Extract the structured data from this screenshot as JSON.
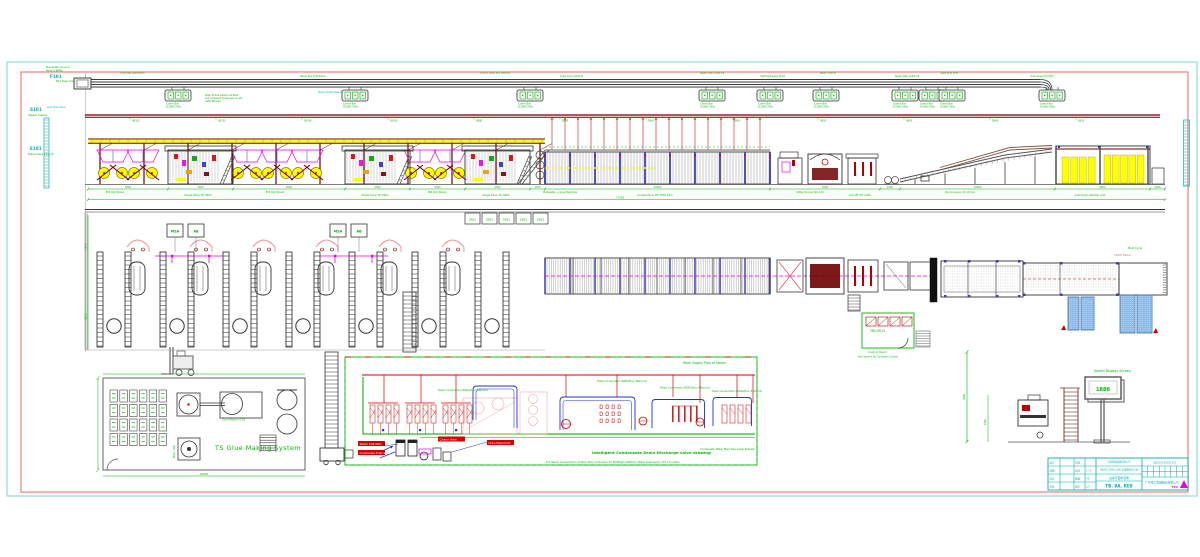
{
  "colors": {
    "green": "#00B400",
    "cyan": "#00AEAE",
    "magenta": "#E800E8",
    "dark_red": "#6E0000",
    "red": "#D40000",
    "yellow": "#FFFF00",
    "blue": "#2233CC",
    "salmon_frame": "#F08880",
    "cyan_frame": "#7AD4D4",
    "stack_blue": "#8FBCE8",
    "pink_label": "#E06868"
  },
  "section_labels": [
    {
      "code": "F101",
      "line1": "Pneumatic Source",
      "line2": "Point 0.8MPa"
    },
    {
      "code": "S101",
      "line1": "Steam Supply",
      "line2": ""
    },
    {
      "code": "E101",
      "line1": "Equipment Layout",
      "line2": ""
    }
  ],
  "margin_notes": {
    "auto_drain": "Auto Drain Valve",
    "pipe_note1": "Note: all free pipes to be fixed",
    "pipe_note2": "and connected by the user on site",
    "pipe_note3": "(refer Manual)",
    "power_note": "Main Power Inlet",
    "steam_valve_note": "Steam Outlet Valve DN50"
  },
  "busbar": {
    "box_caption_1": "Control Box",
    "box_caption_2": "AC380V 50Hz",
    "top_notes": [
      "Crane Rail Distribution",
      "Steam Pipe Distribution",
      "Control Cable Tray 200x100",
      "Cable Trunk 100x100",
      "Steam Main Outlet 1#",
      "Lighting Busway 3P+N",
      "Maint. Hoist 2t",
      "Steam Main Outlet 2#",
      "Cable Drop 4x35",
      "Crane Power End Box"
    ]
  },
  "steam_dims": [
    "DN125",
    "DN125",
    "DN100",
    "DN100",
    "DN80",
    "DN80",
    "DN65",
    "DN65",
    "DN50",
    "DN50",
    "DN40",
    "DN32"
  ],
  "elevation": {
    "machine_labels": [
      "Mill Roll Stand",
      "Single Facer SF-360C",
      "Mill Roll Stand",
      "Single Facer SF-360C",
      "Mill Roll Stand",
      "Single Facer SF-360C",
      "Preheater + Glue Machine",
      "Double Facer BF-2500 18m",
      "Slitter Scorer NC-120",
      "Cut Off HQ-120S",
      "Up Conveyor 15 m/min",
      "Auto Down Stacker Unit"
    ],
    "dims": [
      "5000",
      "2500",
      "5000",
      "2500",
      "5000",
      "2500",
      "1500",
      "22500",
      "4500",
      "1000",
      "15500",
      "9500",
      "1500"
    ],
    "total_dim": "71500"
  },
  "plan": {
    "bay_box_a": "MSA",
    "bay_box_b": "AB",
    "valve_units": [
      "DN25",
      "DN25",
      "DN25",
      "DN25",
      "DN25"
    ],
    "left_dim_top": "2500",
    "left_dim_bottom": "5500",
    "conveyor_label": "1600 52pm",
    "right_label": "Mold Cycle"
  },
  "control_room": {
    "code": "TRC0912",
    "label": "Control Room",
    "sublabel": "Any Section for Condition Control"
  },
  "glue_room": {
    "title": "TS Glue Making System",
    "tank_label": "Corn Starch 2.5t",
    "mixer_label": "Mixer 3kW",
    "room_dim": "20000"
  },
  "speed_screen": {
    "label": "Speed Display Screen",
    "display": "1888",
    "dim1": "1500",
    "dim2": "3000"
  },
  "schematic": {
    "title": "Work Supply Pipe of Steam",
    "caption": "Intelligent Condensate Drain Discharge valve drawing",
    "subcaption": "Full Steam Consumption at Work Duty production for 5000kg/h 380t/min Water heat supply 175 C function",
    "right_label": "Condensate Water Main Pipe Lower Bracket",
    "loop_labels": [
      "Steam Consumption 900KG/Hour 9Bar/cm2",
      "Steam Consumption 900KG/Hour 9Bar/cm2",
      "Steam Consumption 800KG/Hour 8Bar/cm2",
      "Steam Consumption 600KG/Hour 8Bar/cm2"
    ],
    "callouts": [
      "Steam Inlet Main",
      "Condensate Drain Main",
      "Drain Equipment",
      "Control Valve"
    ]
  },
  "title_block": {
    "left_col": [
      "设计",
      "制图",
      "校对",
      "审核"
    ],
    "mid_col": [
      "日期",
      "比例",
      "图幅",
      "张次"
    ],
    "mid_val": [
      "",
      "1:75",
      "A0",
      "1/1"
    ],
    "company_small": "包装机械设备有限公司",
    "project": "WJ250-2500-1600 瓦楞纸板生产线",
    "drawing_title": "设备平面布置图",
    "drawing_code": "TB. 8A. KE8",
    "doc_no": "WJ250-2500-2-0",
    "company_full": "广东重工机械制造有限公司",
    "logo_text": "TSV"
  }
}
